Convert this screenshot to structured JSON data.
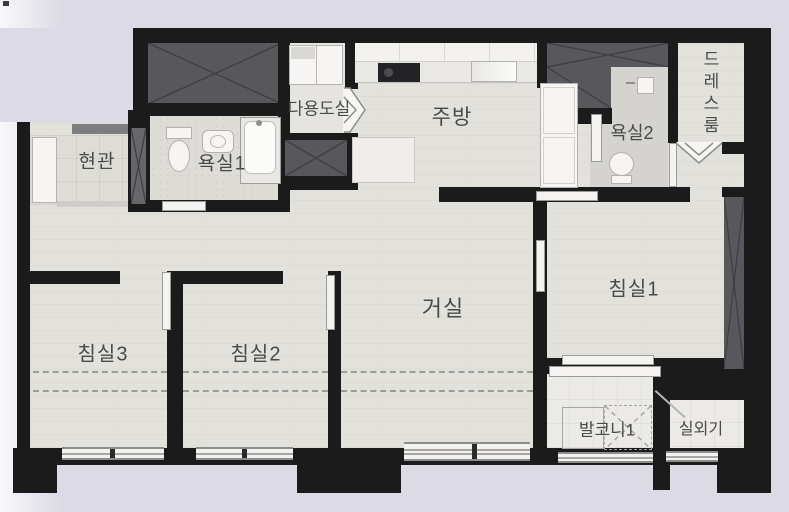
{
  "floorplan": {
    "type": "apartment-unit-plan",
    "rooms": {
      "entrance": {
        "label": "현관"
      },
      "bathroom1": {
        "label": "욕실1"
      },
      "utility_room": {
        "label": "다용도실"
      },
      "kitchen": {
        "label": "주방"
      },
      "bathroom2": {
        "label": "욕실2"
      },
      "dress_room": {
        "label": "드레스룸"
      },
      "bedroom1": {
        "label": "침실1"
      },
      "living_room": {
        "label": "거실"
      },
      "bedroom2": {
        "label": "침실2"
      },
      "bedroom3": {
        "label": "침실3"
      },
      "balcony1": {
        "label": "발코니1"
      },
      "ac_outdoor_unit": {
        "label": "실외기"
      }
    },
    "colors": {
      "background": "#dcdbe5",
      "wall": "#1b1b1c",
      "wood_floor": "#e3e1dc",
      "tile_floor": "#dedcd7",
      "shaft_gray": "#58585c",
      "label_text": "#4a4a48"
    }
  }
}
